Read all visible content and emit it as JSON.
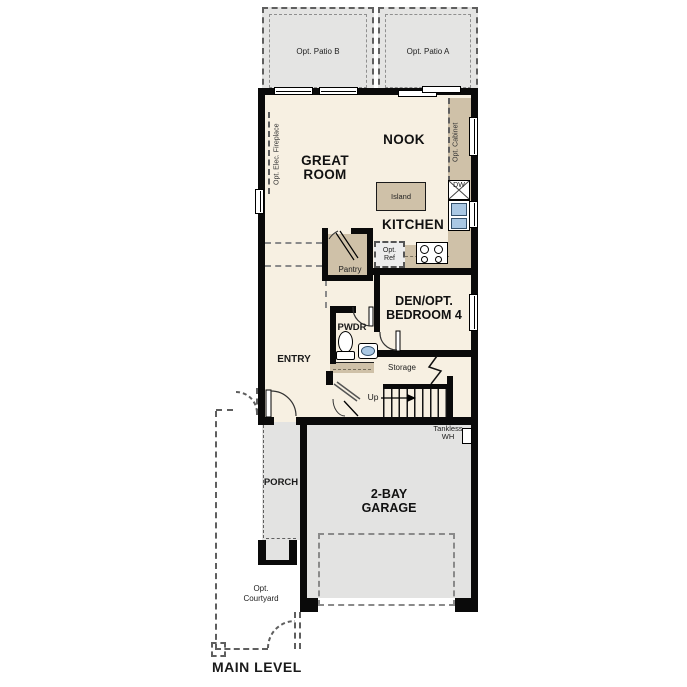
{
  "plan_title": "MAIN LEVEL",
  "colors": {
    "wall": "#0a0a0a",
    "floor": "#f7f0e2",
    "counter": "#cfc1a8",
    "patio_gray": "#e4e4e3",
    "garage_gray": "#e3e3e2",
    "sink_blue": "#aac8e4"
  },
  "patios": {
    "patio_b": "Opt. Patio B",
    "patio_a": "Opt. Patio A"
  },
  "rooms": {
    "great_room": {
      "line1": "GREAT",
      "line2": "ROOM"
    },
    "nook": "NOOK",
    "kitchen": "KITCHEN",
    "pantry": "Pantry",
    "den": {
      "line1": "DEN/OPT.",
      "line2": "BEDROOM 4"
    },
    "pwdr": "PWDR",
    "entry": "ENTRY",
    "storage": "Storage",
    "porch": "PORCH",
    "garage": {
      "line1": "2-BAY",
      "line2": "GARAGE"
    },
    "courtyard": {
      "line1": "Opt.",
      "line2": "Courtyard"
    }
  },
  "fixtures": {
    "island": "Island",
    "dishwasher": "DW",
    "opt_ref": {
      "line1": "Opt.",
      "line2": "Ref"
    },
    "opt_cabinet": "Opt. Cabinet",
    "opt_fireplace": "Opt. Elec. Fireplace",
    "tankless": {
      "line1": "Tankless",
      "line2": "WH"
    },
    "stairs_up": "Up"
  }
}
